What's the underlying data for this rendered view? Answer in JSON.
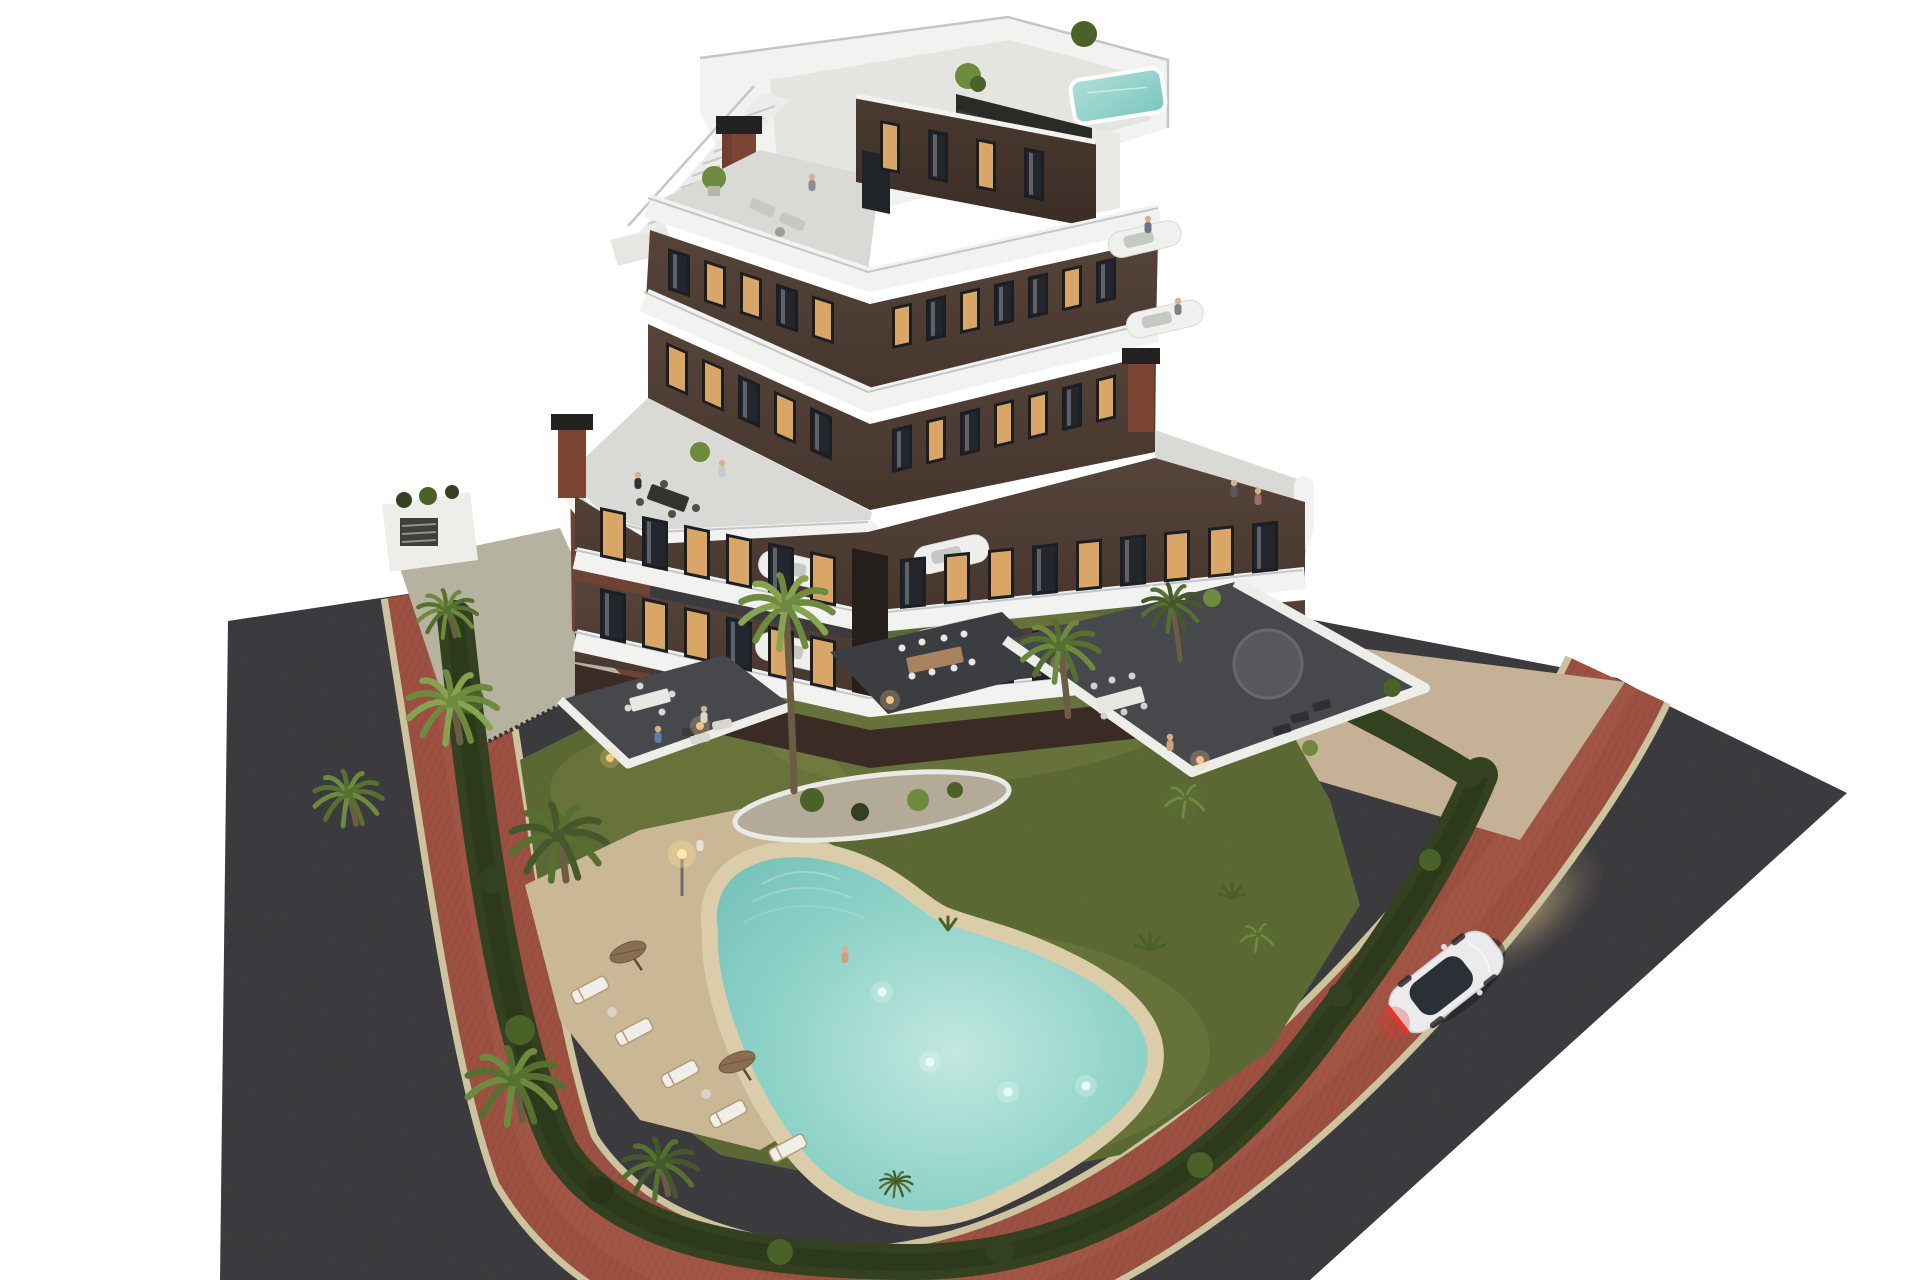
{
  "scene": {
    "type": "3d-architectural-render",
    "subject": "aerial dusk view of a modern apartment building with curved white balconies, lagoon pool and garden",
    "time_of_day": "dusk",
    "building": {
      "floors": 7,
      "facade": "dark brown",
      "balcony_bands": "white curved ribbons",
      "rooftop": {
        "pool": true,
        "stairs": true,
        "dark_pergola_wall": true,
        "chimneys": 3
      },
      "roof_terraces": 3
    },
    "amenities": {
      "lagoon_pool": true,
      "underwater_lights": 4,
      "sun_loungers": 5,
      "pool_umbrellas": 2,
      "palm_trees": 12,
      "lawn": true,
      "perimeter_hedge": true
    },
    "surroundings": {
      "roads": "dark asphalt",
      "sidewalk": "red brick band with sand curbs",
      "car": {
        "x": 1446,
        "y": 982,
        "angle": -38,
        "color_name": "white",
        "lights_on": true
      }
    },
    "windows": {
      "rows": [
        {
          "name": "penthouse",
          "x0": 880,
          "y0": 120,
          "dx": 48,
          "count": 4,
          "slope": 0.19,
          "skew": 10.8,
          "w": 20,
          "h": 50,
          "lit": [
            1,
            0,
            1,
            0
          ]
        },
        {
          "name": "f6-left",
          "x0": 668,
          "y0": 248,
          "dx": 36,
          "count": 5,
          "slope": 0.327,
          "skew": 18,
          "w": 22,
          "h": 42,
          "lit": [
            0,
            1,
            1,
            0,
            1
          ]
        },
        {
          "name": "f6-right",
          "x0": 892,
          "y0": 307,
          "dx": 34,
          "count": 7,
          "slope": -0.222,
          "skew": -12.5,
          "w": 20,
          "h": 42,
          "lit": [
            1,
            0,
            1,
            0,
            0,
            1,
            0
          ]
        },
        {
          "name": "f5-left",
          "x0": 666,
          "y0": 342,
          "dx": 36,
          "count": 5,
          "slope": 0.45,
          "skew": 24,
          "w": 22,
          "h": 44,
          "lit": [
            1,
            1,
            0,
            1,
            0
          ]
        },
        {
          "name": "f5-right",
          "x0": 892,
          "y0": 429,
          "dx": 34,
          "count": 7,
          "slope": -0.245,
          "skew": -13.8,
          "w": 20,
          "h": 44,
          "lit": [
            0,
            1,
            0,
            1,
            1,
            0,
            1
          ]
        },
        {
          "name": "f3-left",
          "x0": 600,
          "y0": 507,
          "dx": 42,
          "count": 6,
          "slope": 0.21,
          "skew": 12,
          "w": 26,
          "h": 50,
          "lit": [
            1,
            0,
            1,
            1,
            0,
            1
          ]
        },
        {
          "name": "f3-right",
          "x0": 900,
          "y0": 559,
          "dx": 44,
          "count": 9,
          "slope": -0.101,
          "skew": -5.8,
          "w": 26,
          "h": 50,
          "lit": [
            0,
            1,
            1,
            0,
            1,
            0,
            1,
            1,
            0
          ]
        },
        {
          "name": "f2-left",
          "x0": 600,
          "y0": 588,
          "dx": 42,
          "count": 6,
          "slope": 0.224,
          "skew": 12.6,
          "w": 26,
          "h": 50,
          "lit": [
            0,
            1,
            1,
            0,
            1,
            1
          ]
        },
        {
          "name": "f2-right",
          "x0": 900,
          "y0": 645,
          "dx": 44,
          "count": 9,
          "slope": -0.106,
          "skew": -6,
          "w": 26,
          "h": 50,
          "lit": [
            1,
            0,
            1,
            0,
            1,
            1,
            0,
            1,
            0
          ]
        }
      ]
    },
    "palms": [
      {
        "x": 447,
        "y": 610,
        "s": 1.0,
        "tone": "mid",
        "trunk": 26
      },
      {
        "x": 452,
        "y": 702,
        "s": 1.5,
        "tone": "light",
        "trunk": 40
      },
      {
        "x": 348,
        "y": 794,
        "s": 1.15,
        "tone": "mid",
        "trunk": 30
      },
      {
        "x": 558,
        "y": 836,
        "s": 1.6,
        "tone": "dark",
        "trunk": 44
      },
      {
        "x": 514,
        "y": 1080,
        "s": 1.6,
        "tone": "mid",
        "trunk": 40
      },
      {
        "x": 660,
        "y": 1164,
        "s": 1.25,
        "tone": "dark",
        "trunk": 30
      },
      {
        "x": 786,
        "y": 606,
        "s": 1.55,
        "tone": "light",
        "trunk": 185
      },
      {
        "x": 1060,
        "y": 646,
        "s": 1.3,
        "tone": "mid",
        "trunk": 70
      },
      {
        "x": 1172,
        "y": 604,
        "s": 1.0,
        "tone": "dark",
        "trunk": 56
      },
      {
        "x": 1186,
        "y": 798,
        "s": 0.7,
        "tone": "mid",
        "trunk": 20
      },
      {
        "x": 896,
        "y": 1182,
        "s": 0.55,
        "tone": "dark",
        "trunk": 12
      },
      {
        "x": 1258,
        "y": 935,
        "s": 0.6,
        "tone": "mid",
        "trunk": 14
      }
    ],
    "loungers": [
      {
        "x": 590,
        "y": 990
      },
      {
        "x": 634,
        "y": 1032
      },
      {
        "x": 680,
        "y": 1074
      },
      {
        "x": 728,
        "y": 1114
      },
      {
        "x": 788,
        "y": 1148
      }
    ],
    "people": [
      {
        "x": 812,
        "y": 190,
        "c": "#8a8f94",
        "where": "roof-terrace"
      },
      {
        "x": 1148,
        "y": 232,
        "c": "#6b7480",
        "where": "floor6-balcony"
      },
      {
        "x": 1178,
        "y": 314,
        "c": "#7d8288",
        "where": "floor5-balcony"
      },
      {
        "x": 638,
        "y": 488,
        "c": "#2e3338",
        "where": "left-roof-terrace"
      },
      {
        "x": 722,
        "y": 476,
        "c": "#c8c9cb",
        "where": "left-roof-terrace"
      },
      {
        "x": 1234,
        "y": 496,
        "c": "#555a60",
        "where": "right-roof-terrace"
      },
      {
        "x": 1258,
        "y": 504,
        "c": "#9a6f62",
        "where": "right-roof-terrace"
      },
      {
        "x": 700,
        "y": 850,
        "c": "#e8e3da",
        "where": "pool-lawn"
      },
      {
        "x": 845,
        "y": 962,
        "c": "#caa17e",
        "where": "pool-edge"
      },
      {
        "x": 1170,
        "y": 750,
        "c": "#caa17e",
        "where": "east-terrace"
      },
      {
        "x": 658,
        "y": 742,
        "c": "#5b7fae",
        "where": "west-terrace"
      },
      {
        "x": 704,
        "y": 722,
        "c": "#d8d8d6",
        "where": "west-terrace"
      }
    ],
    "pool": {
      "lights": [
        {
          "x": 930,
          "y": 1062
        },
        {
          "x": 1008,
          "y": 1092
        },
        {
          "x": 1086,
          "y": 1086
        },
        {
          "x": 882,
          "y": 992
        }
      ]
    }
  },
  "palette": {
    "bg": "#ffffff",
    "asphalt": "#333236",
    "asphaltLight": "#3c3b3e",
    "curb": "#cdc39f",
    "brick": "#9c5042",
    "brickDark": "#7e3f33",
    "brickLight": "#b06a52",
    "path": "#c5b296",
    "apron": "#b6b2a0",
    "grass": "#57652f",
    "grassLight": "#6e7a39",
    "grassWarm": "#7d8742",
    "hedge": "#344120",
    "hedgeDark": "#2a3419",
    "palm": "#6d8a3e",
    "palmDark": "#4a6128",
    "palmLight": "#86a350",
    "trunk": "#6d5c45",
    "deck": "#c9b795",
    "sand": "#dbcda9",
    "waterEdge": "#74bfb6",
    "waterMid": "#8ed2c8",
    "waterLight": "#c2e8df",
    "island": "#b3ab97",
    "islandRim": "#e9e9e5",
    "white": "#f2f2f0",
    "whiteShade": "#dcdcd8",
    "marble": "#d9dad6",
    "glass": "#c2c7cb",
    "facade": "#45352c",
    "facadeLight": "#56443a",
    "facadeDark": "#3a2c24",
    "sideRust": "#6e4334",
    "windowDark": "#23262c",
    "windowLit": "#d9a668",
    "frame": "#1b1e23",
    "curtain": "#8e949a",
    "tile": "#46484c",
    "tileDark": "#3b3d41",
    "wallWhite": "#ededea",
    "pergola": "#2a2a26",
    "chimney": "#7c4433",
    "chimneyCap": "#222320",
    "carBody": "#ebebed",
    "carGlass": "#2b2f36",
    "tail": "#e2372c",
    "glow": "#e8c98a",
    "skin": "#d9b08c",
    "sofa": "#c6c8c4",
    "sofaDark": "#3c3d38",
    "wood": "#a9825f",
    "umbrella": "#8a6e50",
    "lounger": "#efeee9",
    "loungerFrame": "#b59c74"
  }
}
